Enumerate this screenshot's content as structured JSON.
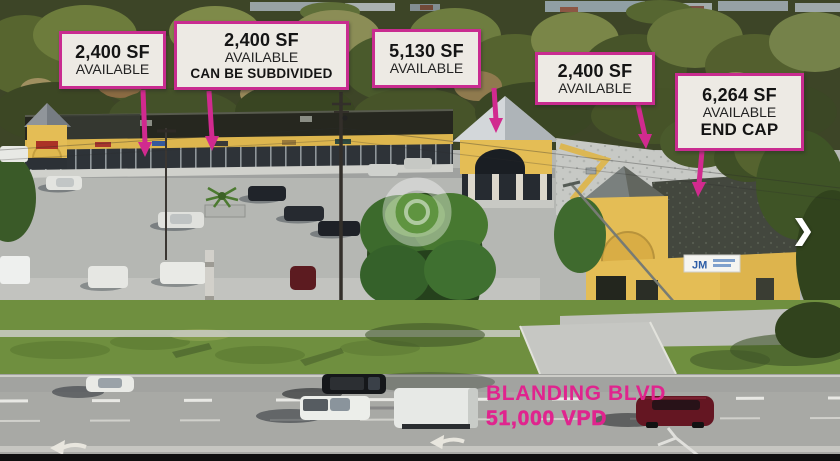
{
  "colors": {
    "accent": "#d12a8f",
    "callout_border": "#c92c90",
    "callout_bg": "#edeae4",
    "callout_text": "#141414",
    "road_label": "#e0248e"
  },
  "callouts": [
    {
      "size": "2,400 SF",
      "availability": "AVAILABLE"
    },
    {
      "size": "2,400 SF",
      "availability": "AVAILABLE",
      "note": "CAN BE SUBDIVIDED"
    },
    {
      "size": "5,130 SF",
      "availability": "AVAILABLE"
    },
    {
      "size": "2,400 SF",
      "availability": "AVAILABLE"
    },
    {
      "size": "6,264 SF",
      "availability": "AVAILABLE",
      "note": "END CAP"
    }
  ],
  "road": {
    "street": "BLANDING BLVD",
    "traffic": "51,000 VPD"
  },
  "building_sign": {
    "text": "JM"
  },
  "icons": {
    "next_arrow": "❯"
  }
}
